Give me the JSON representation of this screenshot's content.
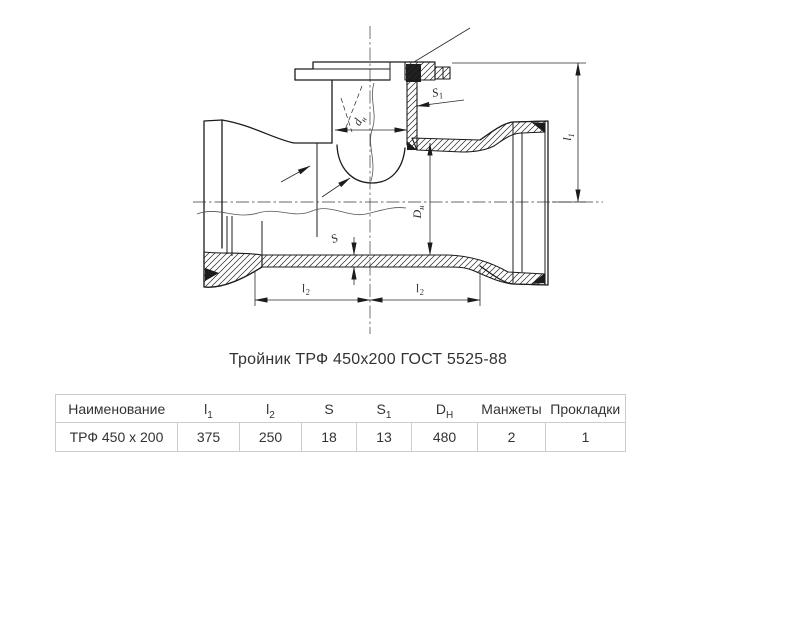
{
  "title": "Тройник ТРФ 450х200 ГОСТ 5525-88",
  "drawing": {
    "dims": {
      "dn": {
        "base": "d",
        "sub": "н"
      },
      "s1": {
        "base": "S",
        "sub": "1"
      },
      "s": {
        "base": "S",
        "sub": ""
      },
      "Dn": {
        "base": "D",
        "sub": "н"
      },
      "l1": {
        "base": "l",
        "sub": "1"
      },
      "l2a": {
        "base": "l",
        "sub": "2"
      },
      "l2b": {
        "base": "l",
        "sub": "2"
      }
    }
  },
  "table": {
    "headers": [
      {
        "base": "Наименование",
        "sub": ""
      },
      {
        "base": "l",
        "sub": "1"
      },
      {
        "base": "l",
        "sub": "2"
      },
      {
        "base": "S",
        "sub": ""
      },
      {
        "base": "S",
        "sub": "1"
      },
      {
        "base": "D",
        "sub": "Н"
      },
      {
        "base": "Манжеты",
        "sub": ""
      },
      {
        "base": "Прокладки",
        "sub": ""
      }
    ],
    "row": [
      "ТРФ 450 х 200",
      "375",
      "250",
      "18",
      "13",
      "480",
      "2",
      "1"
    ]
  },
  "colors": {
    "line": "#1c1c1c",
    "dimension": "#2a2a2a",
    "table_border": "#cccccc",
    "text": "#333333"
  }
}
